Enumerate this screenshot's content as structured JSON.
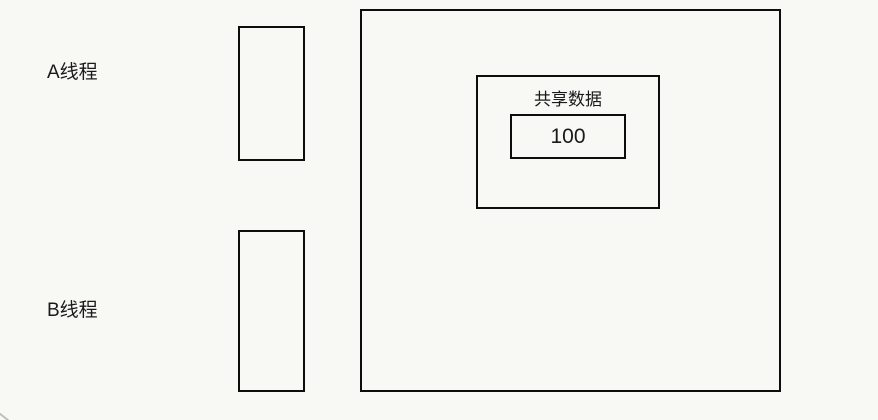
{
  "diagram": {
    "thread_a_label": "A线程",
    "thread_b_label": "B线程",
    "shared_data": {
      "label": "共享数据",
      "value": "100"
    }
  },
  "colors": {
    "background": "#f8f9f4",
    "stroke": "#0d0d0d",
    "text": "#1a1a1a"
  }
}
